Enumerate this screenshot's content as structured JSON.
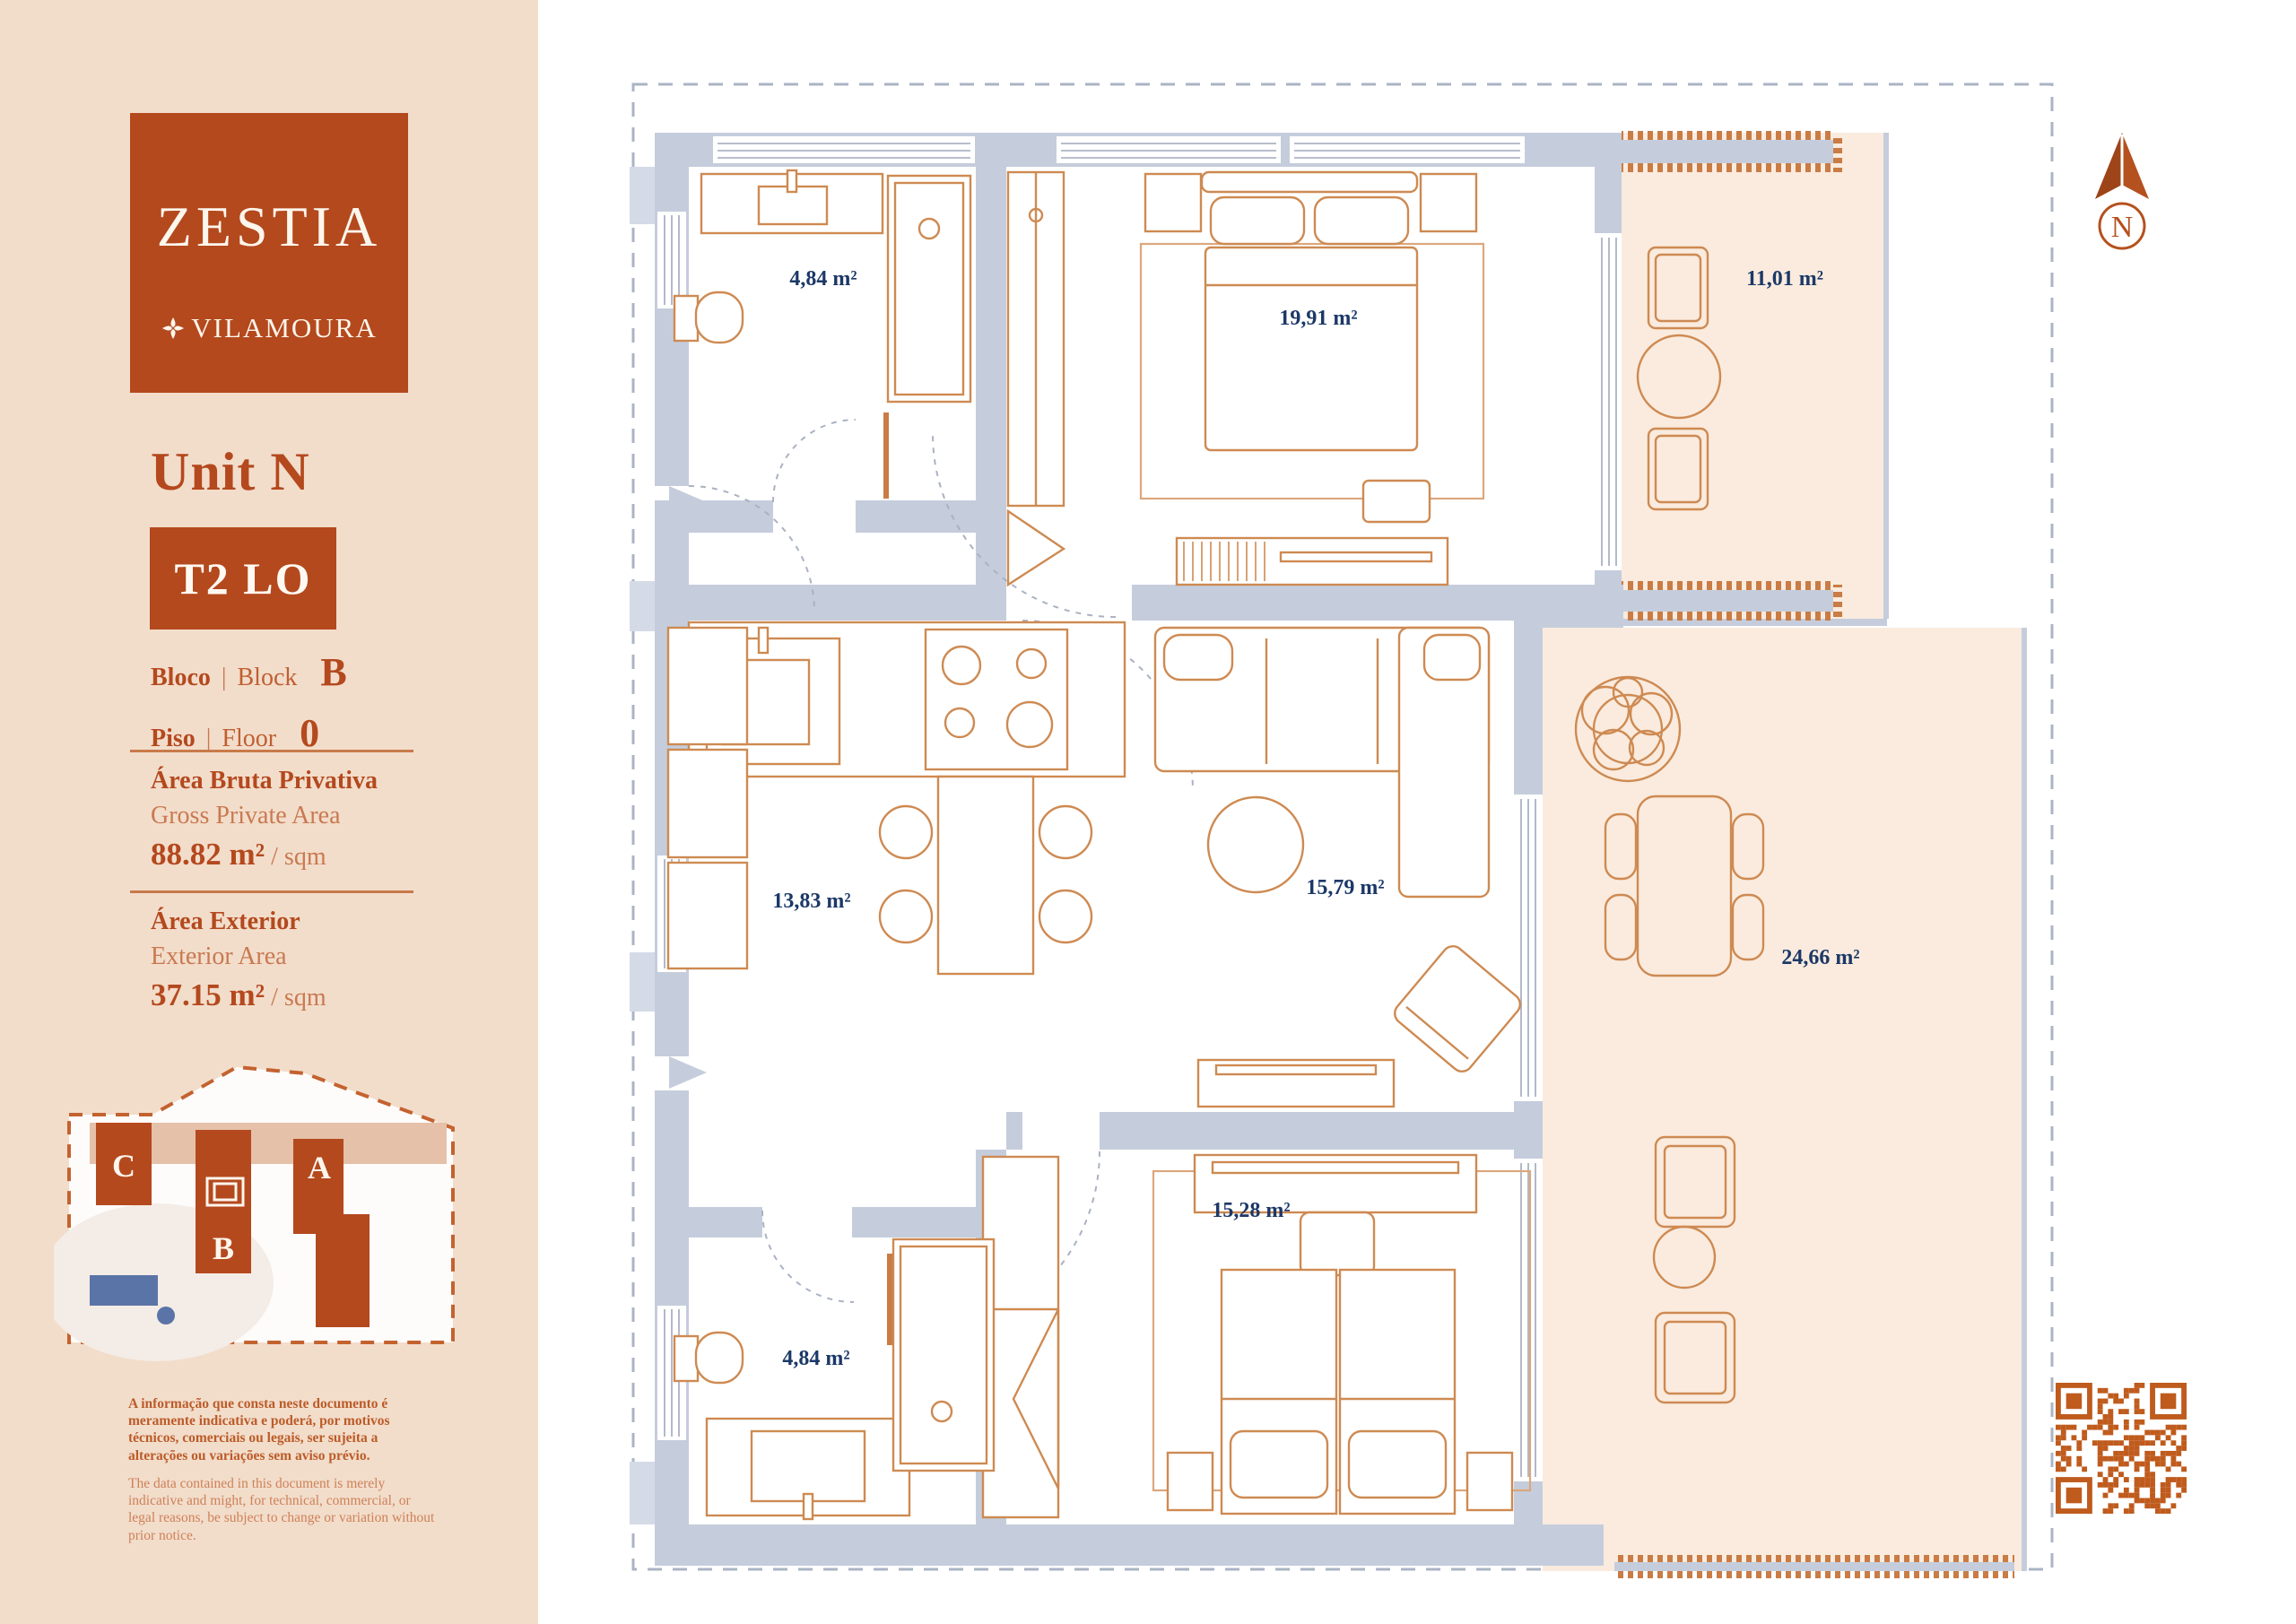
{
  "colors": {
    "brand_orange": "#B4491E",
    "sidebar_bg": "#F2DDCB",
    "wall_gray_blue": "#C5CDDC",
    "furniture_orange": "#CE8A52",
    "terrace_peach": "#FAEBDE",
    "label_navy": "#1C3867",
    "pool_blue": "#5B74A7",
    "qr_orange": "#BF5B1D"
  },
  "sidebar": {
    "logo": {
      "brand": "ZESTIA",
      "location": "VILAMOURA"
    },
    "unit_label": "Unit N",
    "unit_type": "T2 LO",
    "block": {
      "label_pt": "Bloco",
      "sep": "|",
      "label_en": "Block",
      "value": "B"
    },
    "floor": {
      "label_pt": "Piso",
      "sep": "|",
      "label_en": "Floor",
      "value": "0"
    },
    "gross_area": {
      "title_pt": "Área Bruta Privativa",
      "title_en": "Gross Private Area",
      "value": "88.82 m²",
      "unit": "/ sqm"
    },
    "exterior_area": {
      "title_pt": "Área Exterior",
      "title_en": "Exterior Area",
      "value": "37.15 m²",
      "unit": "/ sqm"
    },
    "site_plan": {
      "block_c": "C",
      "block_b": "B",
      "block_a": "A"
    },
    "disclaimer_pt": "A informação que consta neste documento é meramente indicativa e poderá, por motivos técnicos, comerciais ou legais, ser sujeita a alterações ou variações sem aviso prévio.",
    "disclaimer_en": "The data contained in this document is merely indicative and might, for technical, commercial, or legal reasons, be subject to change or variation without prior notice."
  },
  "plan": {
    "rooms": [
      {
        "id": "bathroom-1",
        "area": "4,84 m²"
      },
      {
        "id": "bedroom-1",
        "area": "19,91 m²"
      },
      {
        "id": "terrace-1",
        "area": "11,01 m²"
      },
      {
        "id": "kitchen",
        "area": "13,83 m²"
      },
      {
        "id": "living-room",
        "area": "15,79 m²"
      },
      {
        "id": "exterior",
        "area": "24,66 m²"
      },
      {
        "id": "bedroom-2",
        "area": "15,28 m²"
      },
      {
        "id": "bathroom-2",
        "area": "4,84 m²"
      }
    ],
    "compass": {
      "label": "N"
    }
  }
}
